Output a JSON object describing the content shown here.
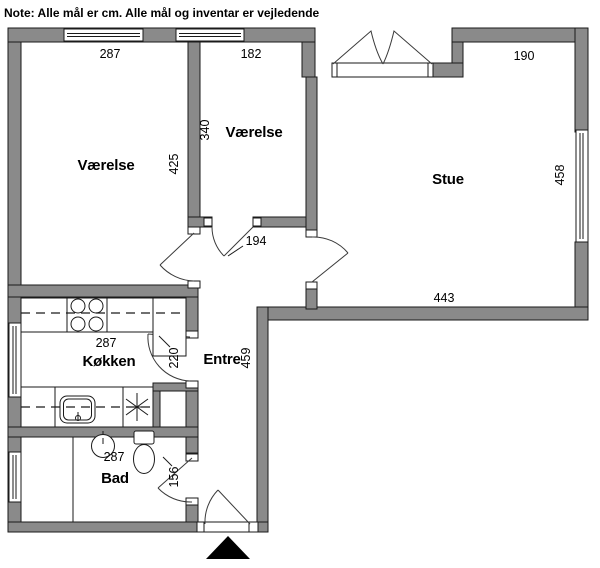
{
  "note": "Note: Alle mål er cm. Alle mål og inventar er vejledende",
  "rooms": {
    "vaerelse_left": {
      "label": "Værelse",
      "width_cm": "287",
      "depth_cm": "425"
    },
    "vaerelse_mid": {
      "label": "Værelse",
      "width_cm": "182",
      "depth_cm": "340"
    },
    "stue": {
      "label": "Stue",
      "top_cm": "190",
      "right_cm": "458",
      "bottom_cm": "443"
    },
    "koekken": {
      "label": "Køkken",
      "width_cm": "287",
      "door_cm": "220"
    },
    "bad": {
      "label": "Bad",
      "width_cm": "287",
      "door_cm": "156"
    },
    "entre": {
      "label": "Entre",
      "depth_cm": "459",
      "opening_cm": "194"
    }
  },
  "colors": {
    "wall_fill": "#8a8a8a",
    "line": "#1a1a1a",
    "background": "#ffffff"
  }
}
